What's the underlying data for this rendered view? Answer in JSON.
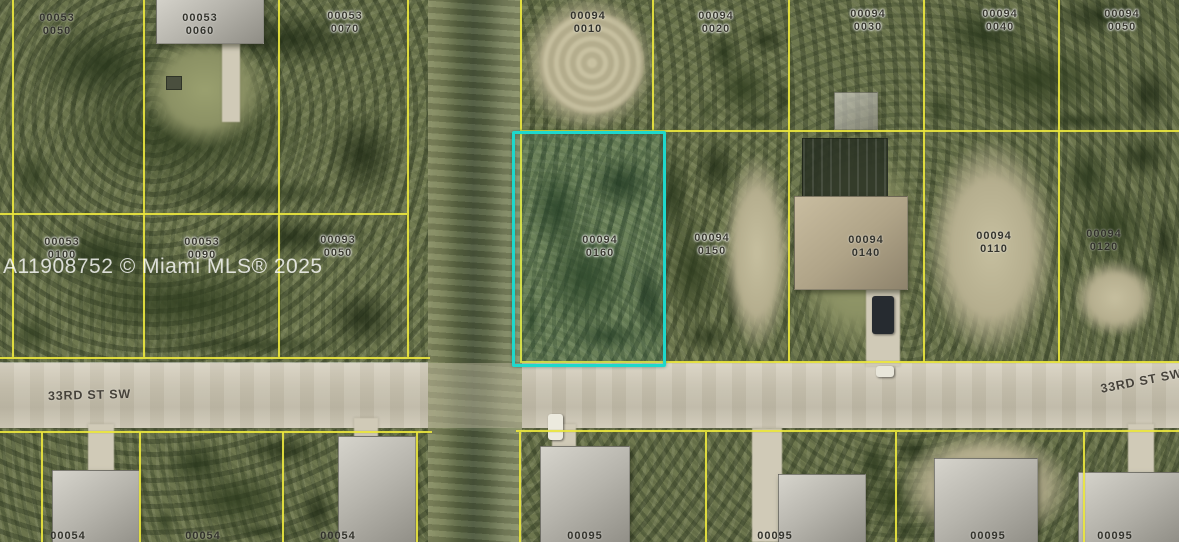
{
  "map": {
    "watermark": "A11908752 © Miami MLS® 2025",
    "street_label_left": "33RD ST SW",
    "street_label_right": "33RD ST SW",
    "highlight_color": "#1ed8cc",
    "parcel_line_color": "#e9e53e",
    "subject_parcel": {
      "block": "00094",
      "lot": "0160"
    },
    "labels": [
      {
        "line1": "00053",
        "line2": "0050"
      },
      {
        "line1": "00053",
        "line2": "0060"
      },
      {
        "line1": "00053",
        "line2": "0070"
      },
      {
        "line1": "00053",
        "line2": "0100"
      },
      {
        "line1": "00053",
        "line2": "0090"
      },
      {
        "line1": "00093",
        "line2": "0050"
      },
      {
        "line1": "00094",
        "line2": "0010"
      },
      {
        "line1": "00094",
        "line2": "0020"
      },
      {
        "line1": "00094",
        "line2": "0030"
      },
      {
        "line1": "00094",
        "line2": "0040"
      },
      {
        "line1": "00094",
        "line2": "0050"
      },
      {
        "line1": "00094",
        "line2": "0160"
      },
      {
        "line1": "00094",
        "line2": "0150"
      },
      {
        "line1": "00094",
        "line2": "0140"
      },
      {
        "line1": "00094",
        "line2": "0110"
      },
      {
        "line1": "00094",
        "line2": "0120"
      }
    ],
    "bottom_labels": [
      "00054",
      "00054",
      "00054",
      "00095",
      "00095",
      "00095",
      "00095"
    ]
  }
}
